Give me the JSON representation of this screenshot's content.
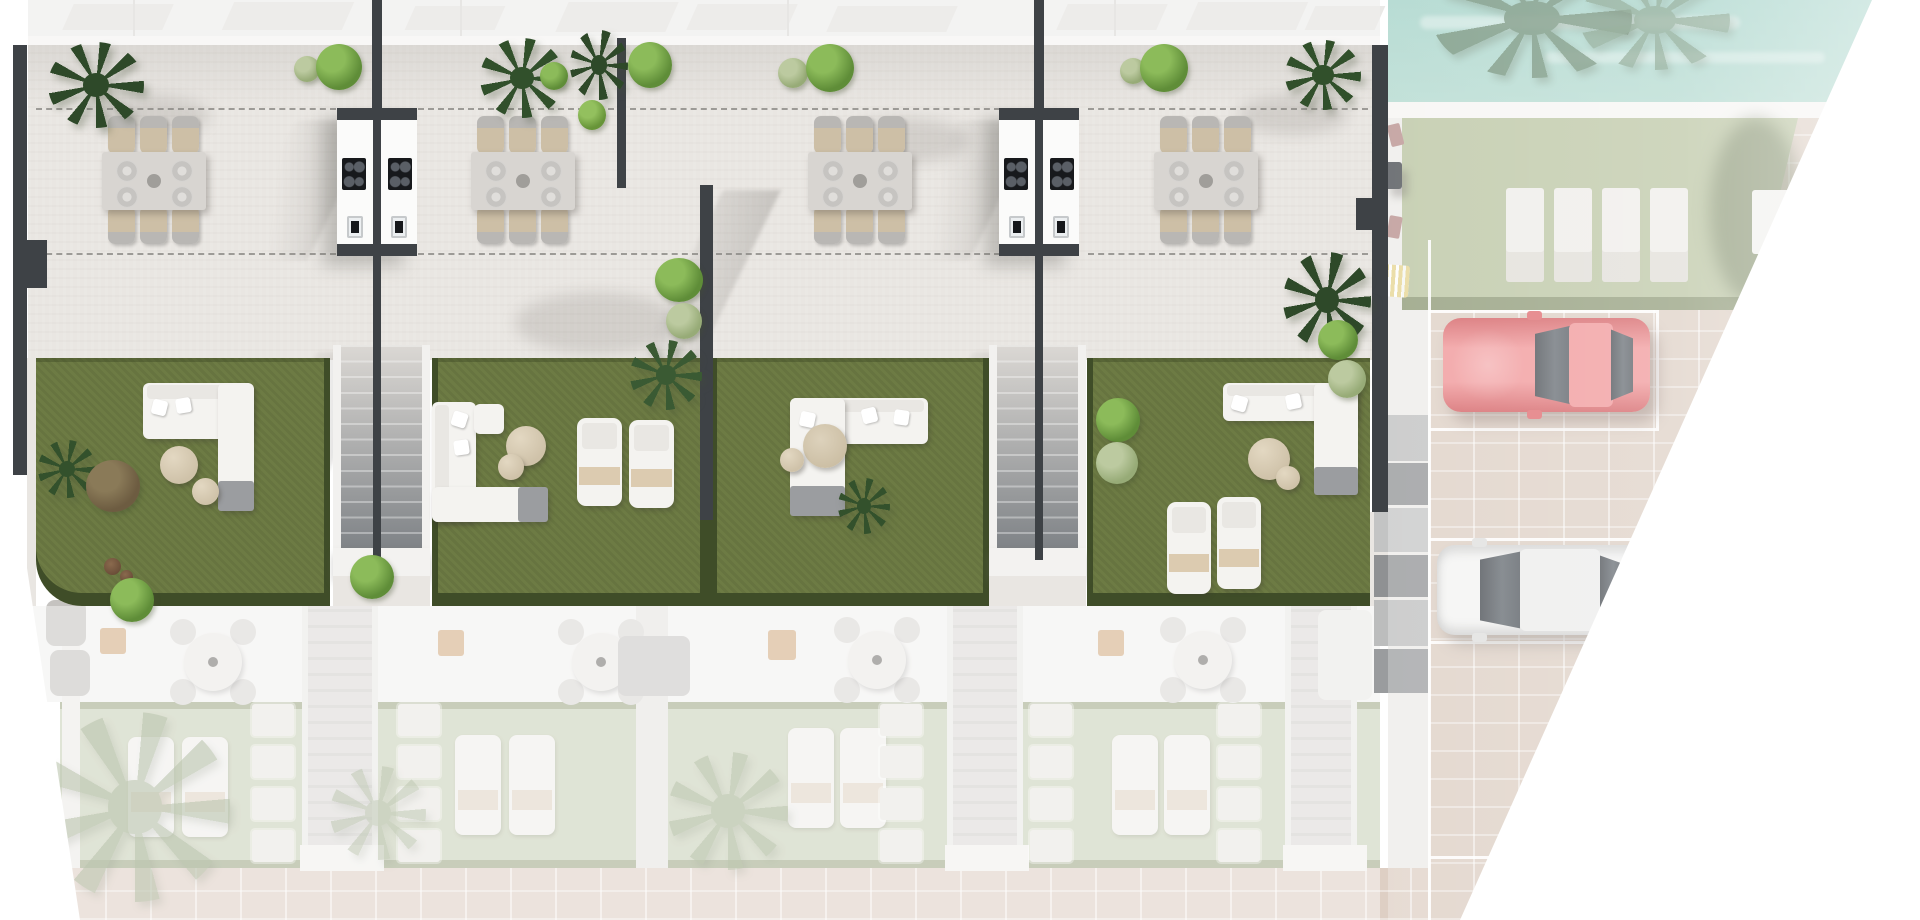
{
  "scene": {
    "type": "architectural-site-plan-render",
    "description": "Top-down 3D render of a row of 4 townhouse units with roof terraces, outdoor kitchens, twin staircases, private gardens, shared pool, lawn with sun pads, and parking with two cars. Lower floor and surroundings shown faded.",
    "units": [
      {
        "id": "unit-1",
        "terrace": {
          "dining_seats": 6,
          "outdoor_kitchen": true
        },
        "garden": {
          "sofa": "L-shaped",
          "poufs": 2,
          "loungers": 0,
          "plants": 4
        }
      },
      {
        "id": "unit-2",
        "terrace": {
          "dining_seats": 6,
          "outdoor_kitchen": true
        },
        "garden": {
          "sofa": "L-shaped",
          "poufs": 2,
          "loungers": 2,
          "plants": 3
        }
      },
      {
        "id": "unit-3",
        "terrace": {
          "dining_seats": 6,
          "outdoor_kitchen": true
        },
        "garden": {
          "sofa": "L-shaped",
          "poufs": 1,
          "loungers": 0,
          "plants": 2
        }
      },
      {
        "id": "unit-4",
        "terrace": {
          "dining_seats": 6,
          "outdoor_kitchen": true
        },
        "garden": {
          "sofa": "L-shaped",
          "poufs": 2,
          "loungers": 2,
          "plants": 3
        }
      }
    ],
    "shared_amenities": {
      "pool": true,
      "sun_pads": 4,
      "bench": 1
    },
    "parking": {
      "spaces_visible": 3,
      "cars": [
        {
          "color_name": "red",
          "position": "upper space"
        },
        {
          "color_name": "white",
          "position": "lower space"
        }
      ]
    },
    "lower_level": {
      "dining_sets": 4,
      "lounger_pairs": 4,
      "stepping_pad_columns": 5,
      "palms": 3
    },
    "labels": {
      "canvas": "site plan",
      "pool": "swimming pool",
      "parking": "parking area",
      "street": "paved street"
    }
  },
  "colors": {
    "page_bg": "#ffffff",
    "terrace": "#e9e6e2",
    "roof": "#ecebe9",
    "roofshadow": "#d9d7d4",
    "wall": "#3e4246",
    "dash": "#8a8884",
    "lawn": "#6d7b44",
    "hedge": "#3f4d28",
    "stair_light": "#dbd8d4",
    "stair_dark": "#7e8286",
    "rail_white": "#f2f1ef",
    "module": "#fbfbfa",
    "cooktop": "#17191c",
    "furn_grey": "#d8d5d1",
    "chair_back": "#b9b7b4",
    "chair_seat": "#cdbfa6",
    "sofa": "#f4f3f0",
    "sofa_cushion": "#e9e7e3",
    "throw": "#9b9da0",
    "pouf": "#cfc2a9",
    "towel": "#d9c6a8",
    "pool": "#aed7cc",
    "pool_light": "#cfe8e0",
    "deck": "#f5f4f2",
    "lawn_r": "#b6c19c",
    "lawn_lower": "#c9d0b8",
    "paver": "#dbccc0",
    "street": "#decfc4",
    "floor_lower": "#f2f1ef",
    "pad": "#edebe7",
    "rose": "#b48b88",
    "yellow": "#e4d28c",
    "grey_block_a": "#bcbdbd",
    "grey_block_b": "#8f9193",
    "car_red": "#dd5f63",
    "car_red_light": "#ef8e90",
    "car_white": "#f2f2f1",
    "glass": "#43484e",
    "line_white": "#ffffff",
    "plant_dark": "#2e4929",
    "plant_mid": "#33512c",
    "plant_bright": "#5f8d38",
    "plant_bright2": "#8cbb5a",
    "plant_sage": "#97ab77",
    "plant_sage2": "#bccaa0",
    "plant_olive": "#8b9c75",
    "plant_brown": "#6d5c41",
    "tan_counter": "#d3ac83"
  }
}
